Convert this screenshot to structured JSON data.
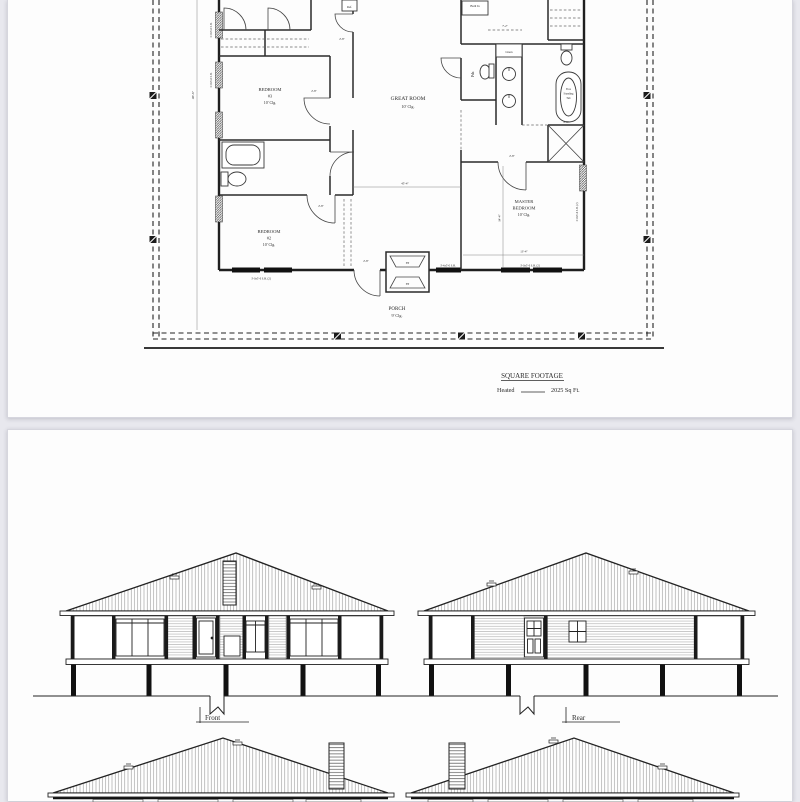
{
  "floor_plan": {
    "rooms": {
      "bedroom3": [
        "BEDROOM",
        "#3",
        "10' Clg."
      ],
      "bedroom2": [
        "BEDROOM",
        "#2",
        "10' Clg."
      ],
      "great_room": [
        "GREAT ROOM",
        "10' Clg."
      ],
      "master_bedroom": [
        "MASTER",
        "BEDROOM",
        "10' Clg."
      ],
      "porch": [
        "PORCH",
        "9' Clg."
      ]
    },
    "fixtures": {
      "powder": "Pdr.",
      "linen": "Linen",
      "built_in": "Built In",
      "fridge": "Ref.",
      "tub": [
        "Free",
        "Standing",
        "Tub"
      ],
      "fireplace": "FP"
    },
    "dimensions": {
      "overall_depth": "46'-6\"",
      "great_room_width": "45'-4\"",
      "master_width": "13'-4\"",
      "master_depth": "14'-4\"",
      "counter": "7'-2\"",
      "door_width": "2'-8\"",
      "shower": "4'-6\""
    },
    "window_labels": {
      "double_hung_pair": "3'-0x5'-0 S.H. (2)",
      "double_hung": "3'-0x5'-0 S.H.",
      "entry_window": "3'-4x5'-0 S.H."
    },
    "square_footage": {
      "title": "SQUARE FOOTAGE",
      "heated_label": "Heated",
      "heated_value": "2025 Sq Ft."
    }
  },
  "elevations": {
    "front_label": "Front",
    "rear_label": "Rear"
  }
}
